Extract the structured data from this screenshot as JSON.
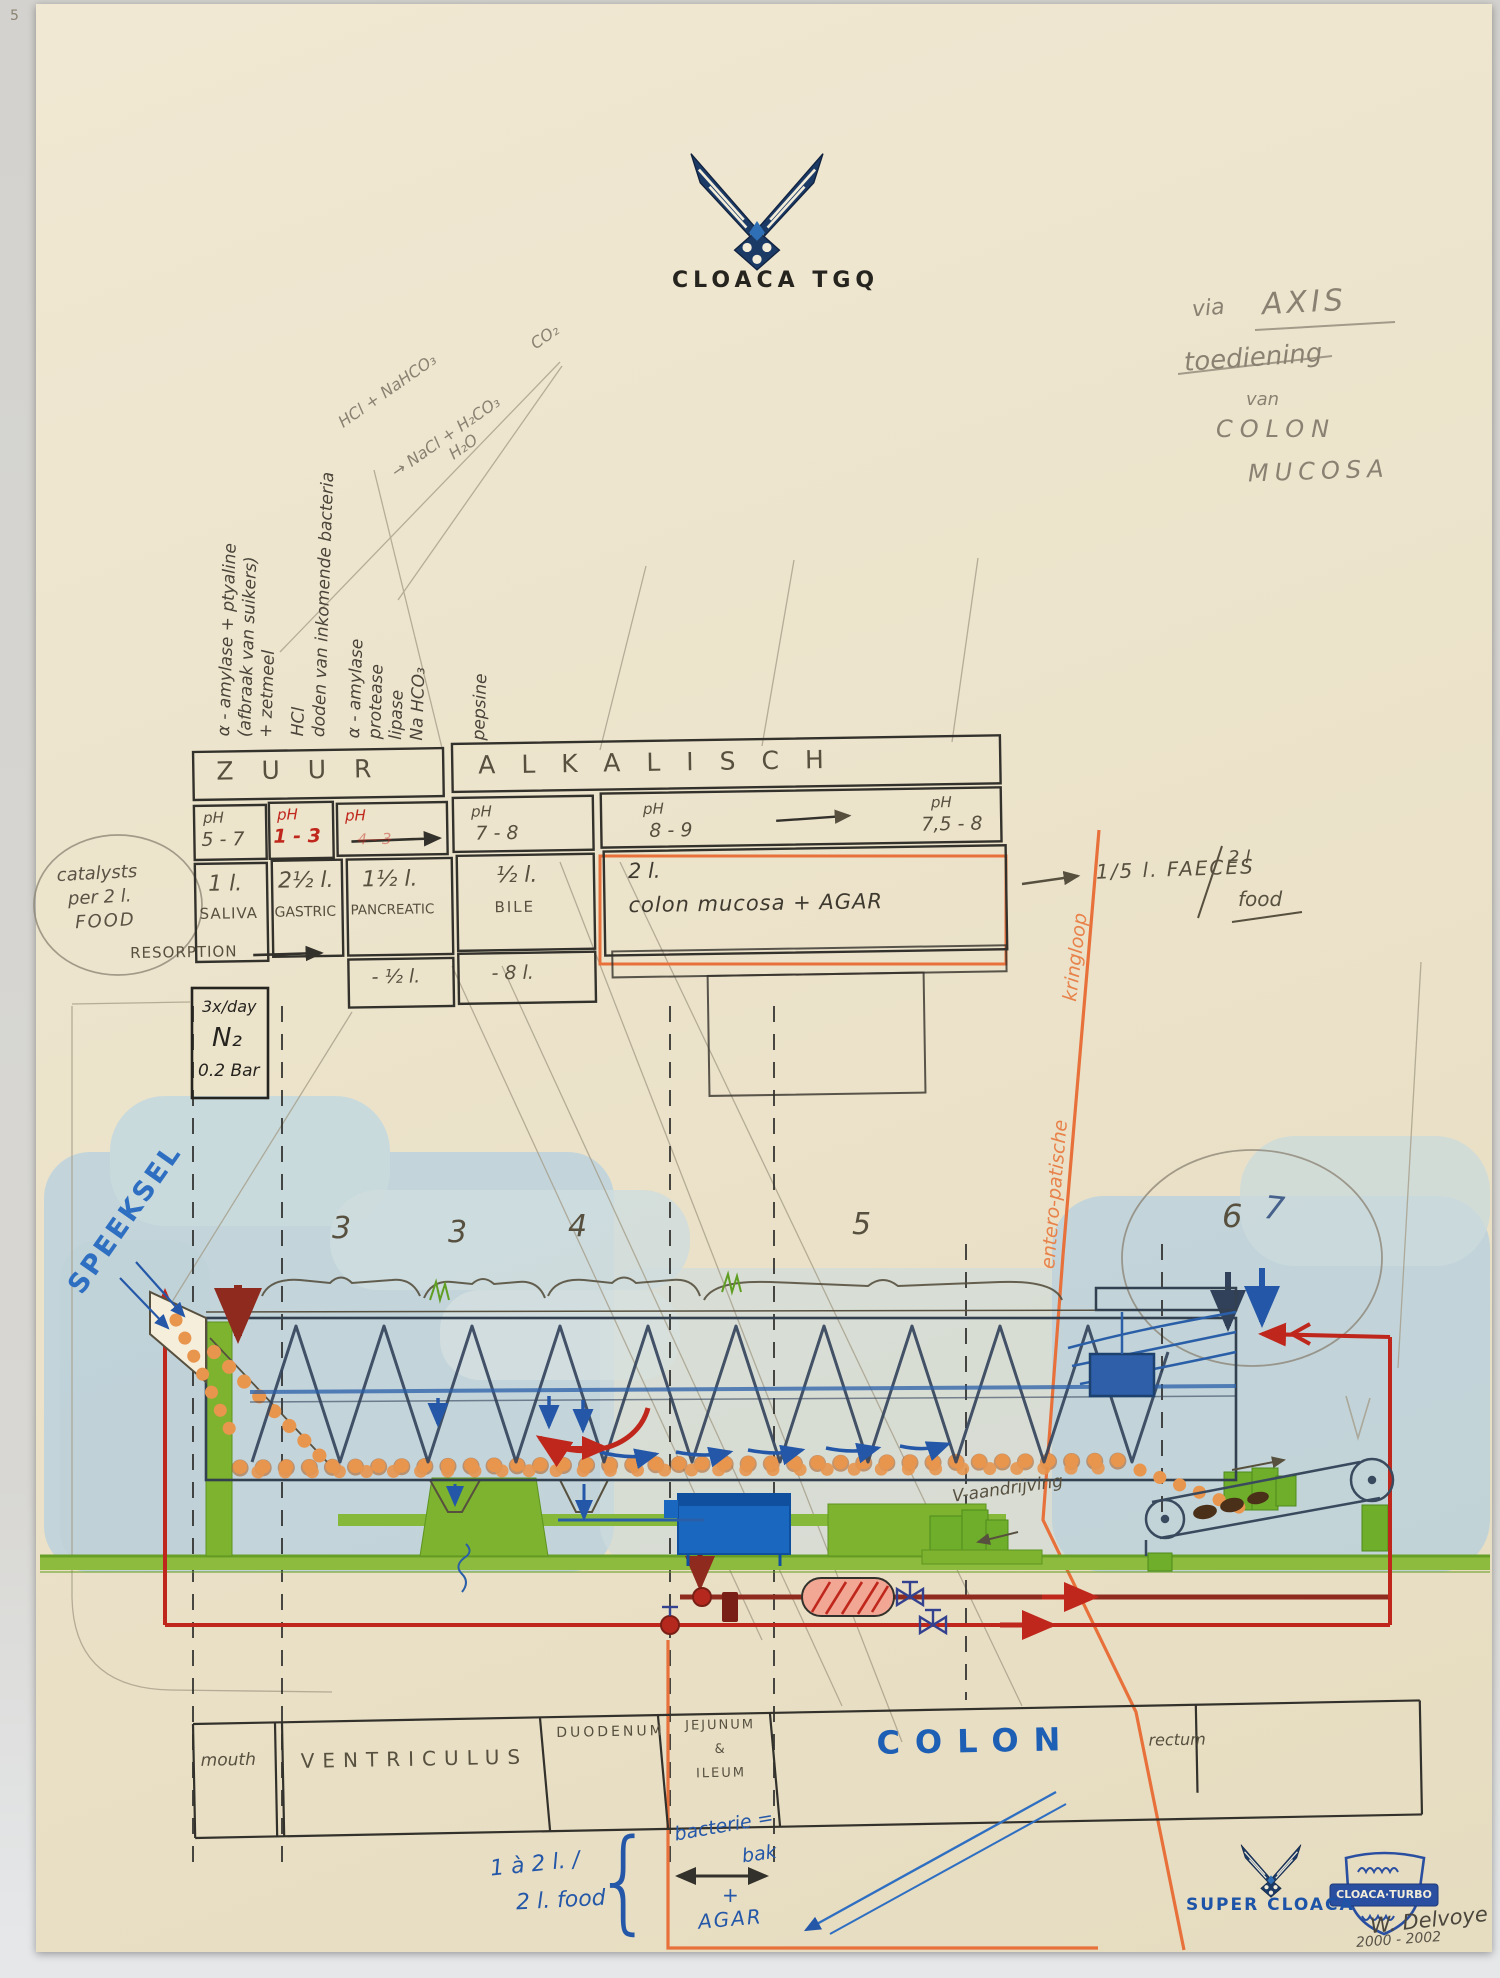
{
  "page": {
    "corner_mark": "5"
  },
  "logo": {
    "title": "CLOACA TGQ"
  },
  "note_top_right": {
    "via": "via",
    "axis": "AXIS",
    "toediening": "toediening",
    "van": "van",
    "colon": "COLON",
    "mucosa": "MUCOSA"
  },
  "chem_note": {
    "l1": "HCl + NaHCO₃",
    "l2": "→ NaCl + H₂CO₃",
    "l3": "H₂O",
    "l4": "CO₂"
  },
  "column_notes": {
    "saliva": [
      "α - amylase + ptyaline",
      "(afbraak van suikers)",
      "+ zetmeel"
    ],
    "gastric": [
      "HCl",
      "doden van inkomende bacteria"
    ],
    "pancreatic": [
      "α - amylase",
      "protease",
      "lipase",
      "Na HCO₃"
    ],
    "pepsine": "pepsine"
  },
  "table": {
    "zuur": "ZUUR",
    "alkalisch": "ALKALISCH",
    "ph": {
      "c1l": "pH",
      "c1v": "5 - 7",
      "c2l": "pH",
      "c2v": "1 - 3",
      "c3l": "pH",
      "c3faint": "4 - 3",
      "c4l": "pH",
      "c4v": "7 - 8",
      "c5l": "pH",
      "c5v": "8 - 9",
      "c6l": "pH",
      "c6v": "7,5 - 8"
    },
    "volumes": {
      "v1a": "1 l.",
      "v1b": "SALIVA",
      "v2a": "2½ l.",
      "v2b": "GASTRIC",
      "v3a": "1½ l.",
      "v3b": "PANCREATIC",
      "v4a": "½ l.",
      "v4b": "BILE",
      "v5a": "2 l.",
      "v5b": "colon mucosa + AGAR"
    },
    "resorption": {
      "label": "RESORPTION",
      "r1": "- ½ l.",
      "r2": "- 8 l."
    },
    "catalysts": [
      "catalysts",
      "per 2 l.",
      "FOOD"
    ],
    "faeces": {
      "a": "1/5 l. FAECES",
      "b": "2 l",
      "c": "food"
    }
  },
  "n2_box": {
    "l1": "3x/day",
    "l2": "N₂",
    "l3": "0.2 Bar"
  },
  "speeksel": "SPEEKSEL",
  "kringloop": {
    "a": "entero-patische",
    "b": "kringloop"
  },
  "sections": {
    "n1": "3",
    "n2": "3",
    "n3": "4",
    "n4": "5",
    "n5": "6",
    "n6": "7"
  },
  "drive_note": "V-aandrijving",
  "organs": {
    "mouth": "mouth",
    "ventriculus": "VENTRICULUS",
    "duodenum": "DUODENUM",
    "jejunum": [
      "JEJUNUM",
      "&",
      "ILEUM"
    ],
    "colon": "COLON",
    "rectum": "rectum"
  },
  "bottom": {
    "intake1": "1 à 2 l. /",
    "intake2": "2 l. food",
    "brace": "{",
    "bak1": "bacterie =",
    "bak2": "bak",
    "plus": "+",
    "agar": "AGAR"
  },
  "branding": {
    "super_cloaca": "SUPER CLOACA",
    "turbo": "CLOACA·TURBO",
    "signature": "W. Delvoye",
    "years": "2000 - 2002"
  }
}
